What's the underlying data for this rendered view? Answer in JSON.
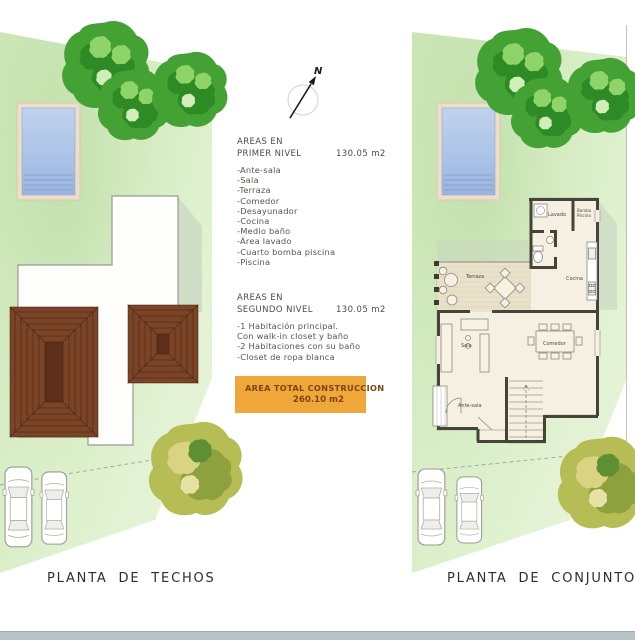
{
  "plans": {
    "left": {
      "title": "PLANTA DE  TECHOS"
    },
    "right": {
      "title": "PLANTA DE  CONJUNTO",
      "rooms": {
        "lavado": "Lavado",
        "bomba_line1": "Bomba",
        "bomba_line2": "Piscina",
        "terraza": "Terraza",
        "cocina": "Cocina",
        "sala": "Sala",
        "comedor": "Comedor",
        "antesala": "Ante-sala"
      }
    }
  },
  "north_arrow": {
    "label": "N"
  },
  "area_first": {
    "label_line1": "AREAS EN",
    "label_line2": "PRIMER NIVEL",
    "value": "130.05 m2",
    "items": [
      "-Ante-sala",
      "-Sala",
      "-Terraza",
      "-Comedor",
      "-Desayunador",
      "-Cocina",
      "-Medio baño",
      "-Área lavado",
      "-Cuarto bomba piscina",
      "-Piscina"
    ]
  },
  "area_second": {
    "label_line1": "AREAS EN",
    "label_line2": "SEGUNDO NIVEL",
    "value": "130.05 m2",
    "items": [
      "-1 Habitación principal.",
      "Con walk-in closet y baño",
      "-2 Habitaciones con su baño",
      "-Closet de ropa blanca"
    ]
  },
  "total": {
    "line1": "AREA TOTAL  CONSTRUCCION",
    "line2": "260.10 m2"
  },
  "colors": {
    "lot_green": "#d7edc4",
    "lot_green_deep": "#c9e5b2",
    "tree_green": "#44a235",
    "tree_green_dark": "#2d8a24",
    "tree_yellow": "#b6bd55",
    "roof_brown": "#7c4426",
    "pool_water": "#aac2e6",
    "pool_deck": "#ebdfca",
    "wall_dark": "#454439",
    "floor_cream": "#f5f0e2",
    "terrace_floor": "#e9e1ca",
    "accent_orange": "#f0a73a",
    "accent_text": "#7e4412",
    "footer_gray": "#b8c3c6"
  }
}
